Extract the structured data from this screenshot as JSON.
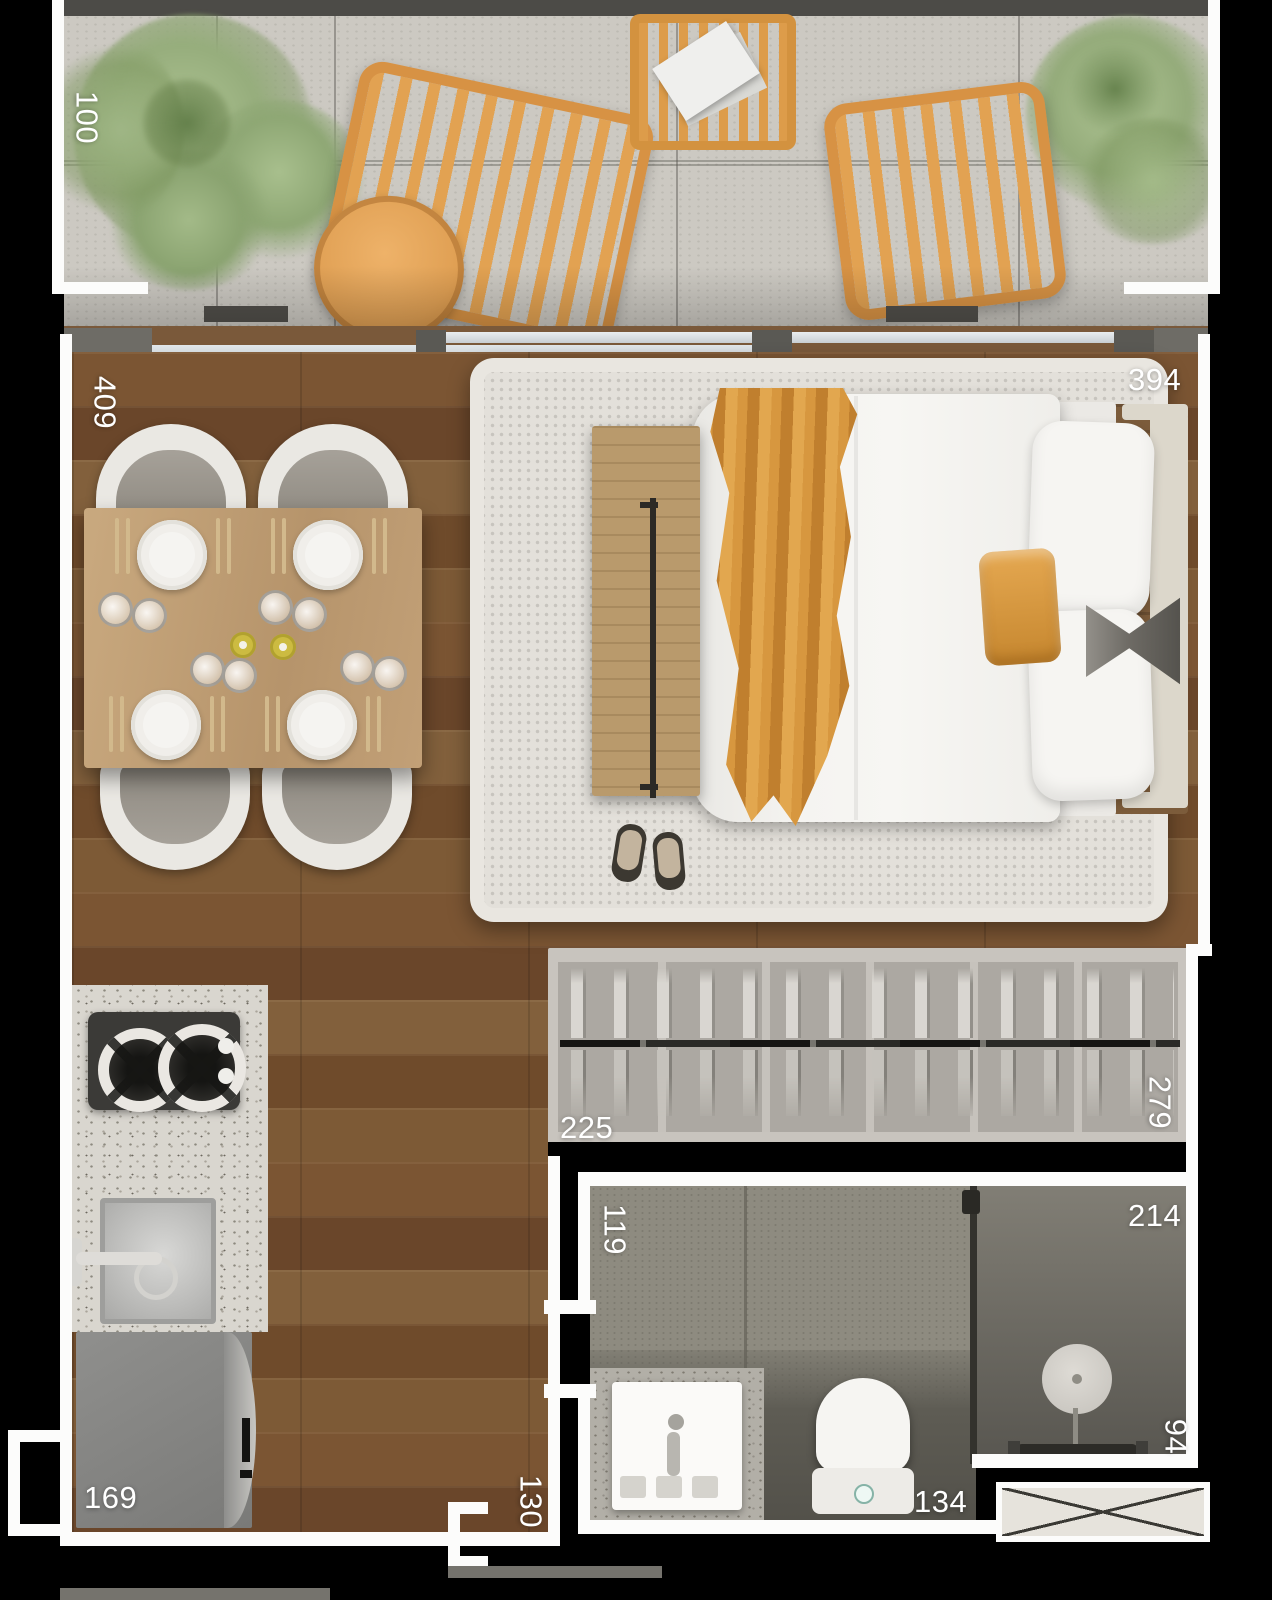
{
  "floorplan": {
    "type": "studio-apartment-top-view-render",
    "dimension_labels": {
      "balcony": "100",
      "living_room": "409",
      "bedroom": "394",
      "closet_width": "225",
      "closet_depth": "279",
      "bathroom_entry": "119",
      "bathroom_width": "214",
      "toilet_zone": "134",
      "shower": "94",
      "hallway": "130",
      "kitchen": "169"
    },
    "colors": {
      "background": "#000000",
      "wall_white": "#fcfcfb",
      "wood_floor": "#744f2e",
      "balcony_tile": "#ccc9c2",
      "accent_orange": "#dd9c4e",
      "throw_orange": "#d7973f",
      "rug": "#e3e0da",
      "closet_body": "#aca8a2",
      "bathroom_floor": "#8e8b80",
      "shower_dark": "#5e5c54",
      "granite_counter": "#d9d6cf",
      "plant_green": "#9cb384",
      "label_text": "#ffffff"
    }
  }
}
